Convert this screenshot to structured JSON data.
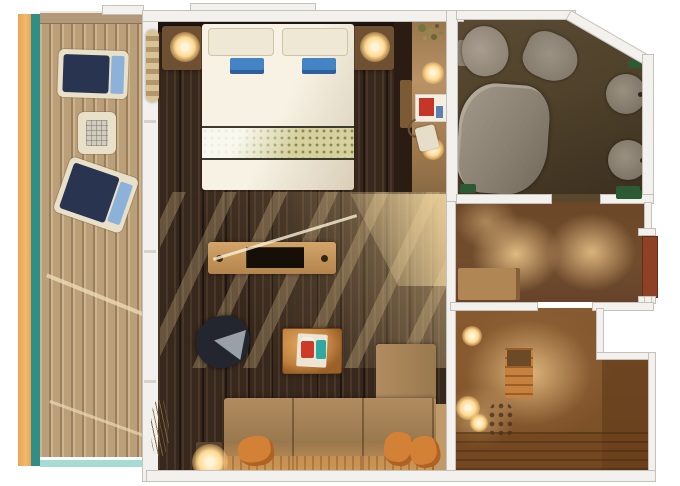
{
  "meta": {
    "type": "floor-plan",
    "subject": "cruise-ship-suite-top-view",
    "canvas": {
      "width": 680,
      "height": 486
    }
  },
  "palette": {
    "wall": "#f3f1ee",
    "wall-edge": "#c6c2bb",
    "balcony-orange": "#e9a455",
    "balcony-teal": "#2f8e85",
    "aqua-strip": "#a6dcd2",
    "deck-light": "#bb9f78",
    "deck-rail": "#b2997a",
    "chair-frame": "#e9e0c9",
    "chair-navy": "#283450",
    "chair-blue": "#8cb2da",
    "floor-dark": "#37281d",
    "headboard": "#201510",
    "bed-white": "#f7f2e4",
    "pillow-cream": "#efe8d5",
    "towel-blue": "#4483c4",
    "runner-base": "#d6d19e",
    "runner-dot": "#8b8a54",
    "runner-line": "#3c3b30",
    "nightstand": "#6e5132",
    "lamp-glow": "#ffd990",
    "lamp-core": "#fff4d8",
    "picture-red": "#c63627",
    "picture-blue": "#5b80b2",
    "tv-screen": "#160f07",
    "chair-dark": "#23262e",
    "chair-gray": "#9aa0a7",
    "table-orange": "#c08140",
    "item-red": "#cd3a28",
    "item-teal": "#2fa9a1",
    "sofa-back": "#b18c60",
    "sofa-seat": "#9a784e",
    "sofa-front": "#c99254",
    "pillow-orange": "#d28136",
    "bath-dark": "#3b2f1f",
    "bath-mid": "#50422b",
    "fixture-gray": "#958b7d",
    "tub-gray": "#8b8173",
    "green-towel": "#2b5a33",
    "corridor-base": "#714c2d",
    "door-red": "#8d4226",
    "hall-base": "#875a30",
    "cabinet-orange": "#c5813d"
  },
  "regions": [
    {
      "id": "balcony",
      "furniture": [
        "lounge-chair",
        "side-table",
        "lounge-chair"
      ]
    },
    {
      "id": "bedroom",
      "furniture": [
        "double-bed",
        "pillows",
        "blue-towels",
        "patterned-runner",
        "nightstand-with-lamp-left",
        "nightstand-with-lamp-right",
        "curtain",
        "wardrobe"
      ]
    },
    {
      "id": "vanity-nook",
      "furniture": [
        "potted-plant",
        "vanity-lamps",
        "framed-picture",
        "hairdryer"
      ]
    },
    {
      "id": "living-room",
      "furniture": [
        "tv-console",
        "desk-chair",
        "coffee-table-with-tray",
        "l-shaped-sofa",
        "orange-cushions",
        "floor-lamp",
        "dried-plant"
      ]
    },
    {
      "id": "bathroom",
      "furniture": [
        "toilet",
        "bidet",
        "bathtub",
        "twin-sinks",
        "green-towels"
      ]
    },
    {
      "id": "dressing-corridor",
      "furniture": [
        "bench",
        "cabin-entry-door"
      ]
    },
    {
      "id": "entrance-hall",
      "furniture": [
        "cabinet",
        "lamps",
        "decor-swirl"
      ]
    }
  ]
}
